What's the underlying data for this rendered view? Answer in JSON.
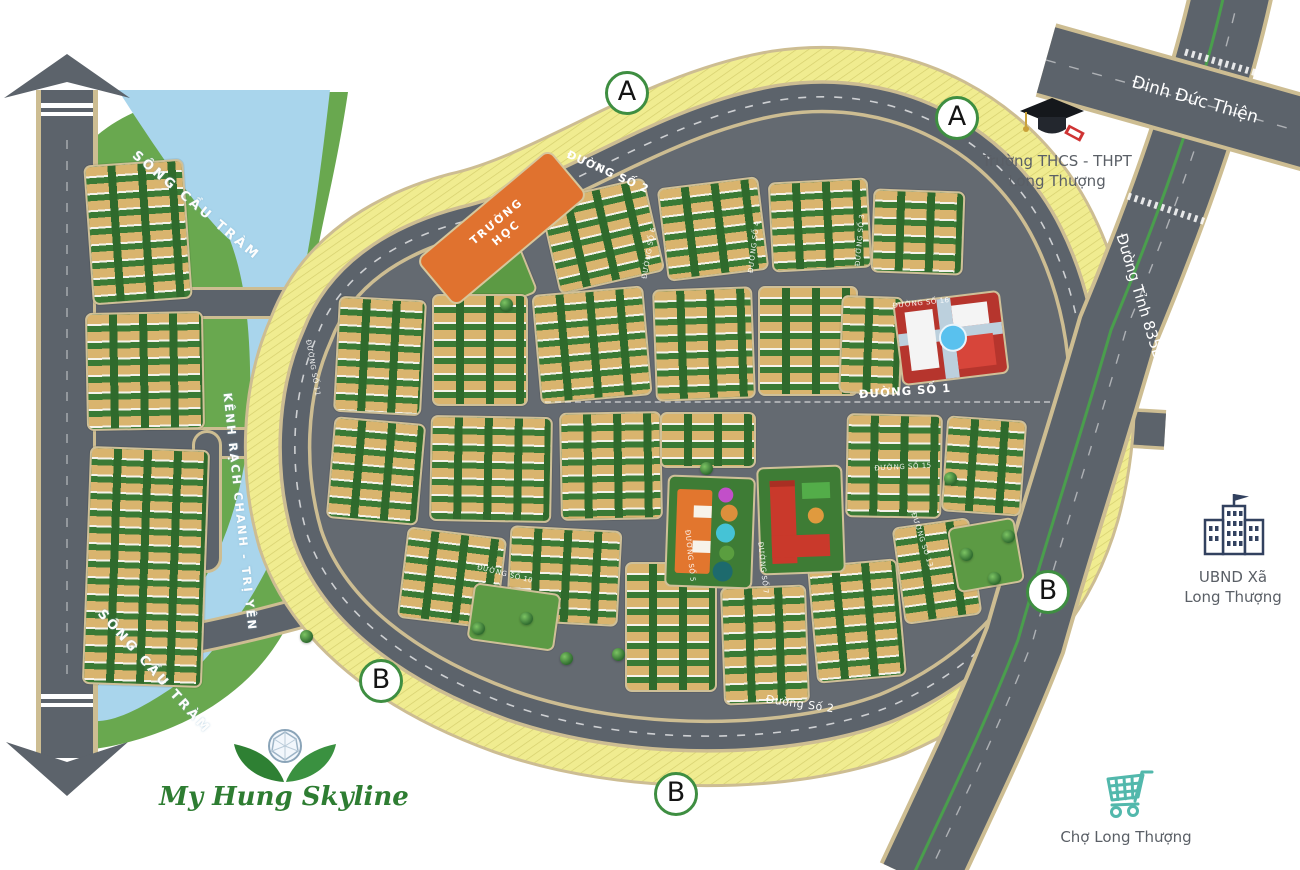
{
  "map": {
    "developer_logo": "My Hung Skyline",
    "zone_markers": [
      {
        "label": "A",
        "x": 627,
        "y": 93
      },
      {
        "label": "A",
        "x": 957,
        "y": 118
      },
      {
        "label": "B",
        "x": 381,
        "y": 681
      },
      {
        "label": "B",
        "x": 676,
        "y": 794
      },
      {
        "label": "B",
        "x": 1048,
        "y": 592
      }
    ],
    "roads": {
      "dinh_duc_thien": "Đinh Đức Thiện",
      "duong_tinh_835b": "Đường Tỉnh 835B",
      "duong_so_2_top": "ĐƯỜNG SỐ 2",
      "duong_so_1": "ĐƯỜNG SỐ 1",
      "duong_so_2_bottom": "Đường Số 2"
    },
    "minor_streets": [
      {
        "label": "ĐƯỜNG SỐ 11",
        "x": 313,
        "y": 368,
        "rot": 80
      },
      {
        "label": "ĐƯỜNG SỐ 6",
        "x": 649,
        "y": 253,
        "rot": -80
      },
      {
        "label": "ĐƯỜNG SỐ 4",
        "x": 754,
        "y": 247,
        "rot": -83
      },
      {
        "label": "ĐƯỜNG SỐ 3",
        "x": 860,
        "y": 240,
        "rot": -85
      },
      {
        "label": "ĐƯỜNG SỐ 16",
        "x": 921,
        "y": 303,
        "rot": -6
      },
      {
        "label": "ĐƯỜNG SỐ 15",
        "x": 903,
        "y": 467,
        "rot": -3
      },
      {
        "label": "ĐƯỜNG SỐ 5",
        "x": 690,
        "y": 556,
        "rot": 84
      },
      {
        "label": "ĐƯỜNG SỐ 7",
        "x": 763,
        "y": 568,
        "rot": 84
      },
      {
        "label": "ĐƯỜNG SỐ 13",
        "x": 922,
        "y": 540,
        "rot": 72
      },
      {
        "label": "ĐƯỜNG SỐ 10",
        "x": 505,
        "y": 574,
        "rot": 14
      }
    ],
    "waterways": {
      "song_cau_tram_upper": "SÔNG CẦU TRÀM",
      "kenh_rach_chanh": "KÊNH RẠCH CHANH - TRỊ YÊN",
      "song_cau_tram_lower": "SÔNG CẦU TRÀM"
    },
    "pois": {
      "school_block": "TRƯỜNG HỌC",
      "school": {
        "line1": "Trường THCS - THPT",
        "line2": "Long Thượng"
      },
      "ubnd": {
        "line1": "UBND Xã",
        "line2": "Long Thượng"
      },
      "market": "Chợ Long Thượng"
    },
    "colors": {
      "road": "#5c636b",
      "road_edge": "#cdbd92",
      "river": "#a9d5ec",
      "land_green": "#69a84f",
      "lot_yellow": "#f0ec90",
      "school_orange": "#e0722f",
      "marker_ring": "#3e8e41",
      "logo_green": "#2e7d32",
      "cart_teal": "#52b8ac",
      "ubnd_navy": "#32415f"
    }
  }
}
